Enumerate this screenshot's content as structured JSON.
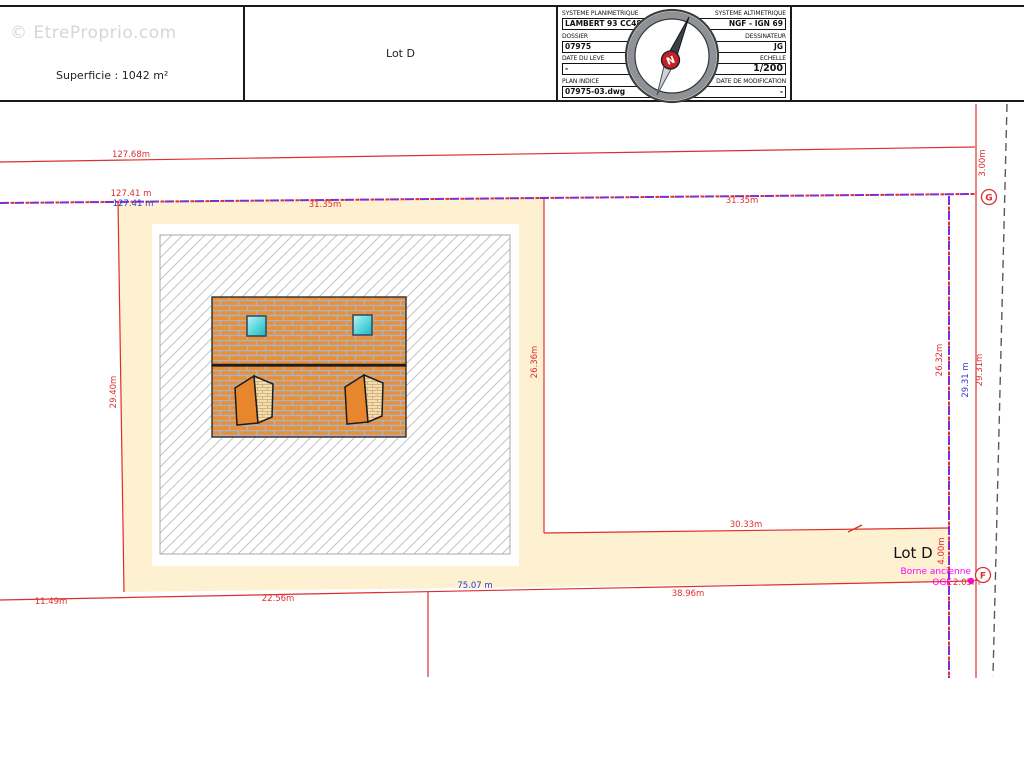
{
  "watermark": "© EtreProprio.com",
  "header": {
    "superficie": "Superficie : 1042 m²",
    "lot_label": "Lot D",
    "title_block": {
      "fields": [
        {
          "label": "SYSTEME PLANIMETRIQUE",
          "value": "LAMBERT 93 CC48"
        },
        {
          "label": "SYSTEME ALTIMETRIQUE",
          "value": "NGF - IGN 69"
        },
        {
          "label": "DOSSIER",
          "value": "07975"
        },
        {
          "label": "DESSINATEUR",
          "value": "JG"
        },
        {
          "label": "DATE DU LEVE",
          "value": "-"
        },
        {
          "label": "ECHELLE",
          "value": "1/200"
        },
        {
          "label": "PLAN INDICE",
          "value": "07975-03.dwg"
        },
        {
          "label": "DATE DE MODIFICATION",
          "value": "-"
        }
      ],
      "compass_letter": "N"
    }
  },
  "plan": {
    "lot_name": "Lot D",
    "dims": {
      "top": "127.68m",
      "bound_red": "127.41 m",
      "bound_blue": "127.41 m",
      "seg_left": "31.35m",
      "seg_right": "31.35m",
      "gap_right": "3.00m",
      "left_side": "29.40m",
      "mid_side": "26.36m",
      "right_purple": "26.32m",
      "right_blue": "29.31 m",
      "right_red": "29.31m",
      "corridor_top": "30.33m",
      "corridor_width": "4.00m",
      "bottom_blue": "75.07 m",
      "bottom_left": "11.49m",
      "bottom_mid": "22.56m",
      "bottom_right": "38.96m"
    },
    "markers": {
      "g": "G",
      "f": "F"
    },
    "notes": {
      "borne_line1": "Borne ancienne",
      "borne_line2": "OGE",
      "borne_dim": "2.05m"
    },
    "colors": {
      "lot_fill": "#fdf1d2",
      "dim_red": "#dd2f2f",
      "dim_blue": "#2b3fcc",
      "boundary_purple": "#7b2fd0",
      "note_magenta": "#ff00ff",
      "building_orange": "#e98f35"
    }
  }
}
